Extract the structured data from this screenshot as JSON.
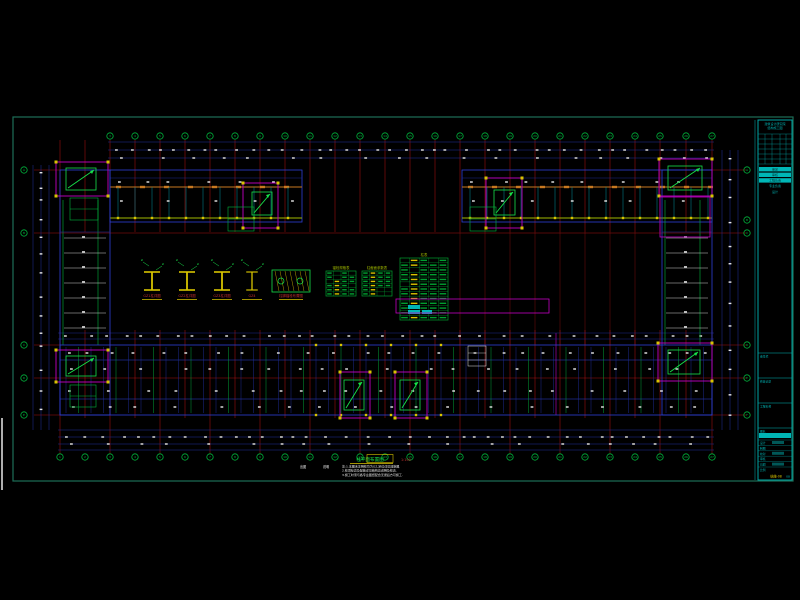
{
  "meta": {
    "canvas_w": 800,
    "canvas_h": 600
  },
  "colors": {
    "background": "#000000",
    "frame": "#1d6e58",
    "grid_red": "#a81212",
    "beam_blue": "#2d3fd6",
    "beam_blue_dim": "#1f2f9e",
    "joist_cyan": "#00939e",
    "green": "#00b43c",
    "bright_green": "#17e24a",
    "magenta": "#c400c4",
    "yellow": "#d8c400",
    "orange": "#c87820",
    "olive": "#9fb800",
    "cyan": "#00b6b6",
    "white": "#e8e8e8",
    "label_red": "#c23030",
    "table_green": "#00a030"
  },
  "footer": {
    "legend_a": "出图",
    "legend_b": "说明",
    "title": "柱平面布置图",
    "scale": "1:100",
    "notes": [
      "注:1.本图未注明柱均为GZ,定位详见建施图.",
      "2.柱顶标高及配筋详见结构总说明及柱表.",
      "3.施工时须与各专业图纸配合无误后方可施工."
    ]
  },
  "details": {
    "items": [
      {
        "label": "GZ1柱详图"
      },
      {
        "label": "GZ2柱详图"
      },
      {
        "label": "GZ3柱详图"
      },
      {
        "label": "GZ4"
      },
      {
        "label": "柱脚锚栓布置图"
      }
    ],
    "small_tables": [
      {
        "title": "锚栓规格表",
        "rows": 6,
        "cols": 4
      },
      {
        "title": "柱截面参数表",
        "rows": 6,
        "cols": 4
      }
    ],
    "main_table": {
      "title": "柱表",
      "rows": 13,
      "cols": 5
    }
  },
  "title_block": {
    "header": [
      "建筑设计研究院",
      "结构施工图"
    ],
    "rev_rows": 6,
    "info_rows": [
      "审定",
      "审核",
      "工程负责",
      "专业负责",
      "设计"
    ],
    "sections": [
      "会签栏",
      "修改记录",
      "工程名称",
      "图名"
    ],
    "stamp": {
      "labels": [
        "设计",
        "制图",
        "校对",
        "审核",
        "日期",
        "比例"
      ],
      "drawing_no": "结施-08",
      "sheet": "08"
    }
  },
  "drawing": {
    "frame": {
      "x": 13,
      "y": 117,
      "w": 780,
      "h": 364
    },
    "edge_line": {
      "x": 2,
      "y1": 418,
      "y2": 490
    },
    "axes_x": [
      60,
      85,
      110,
      135,
      160,
      185,
      210,
      235,
      260,
      285,
      310,
      335,
      360,
      385,
      410,
      435,
      460,
      485,
      510,
      535,
      560,
      585,
      610,
      635,
      660,
      686,
      712
    ],
    "courtyard_x": [
      460,
      485,
      510,
      535,
      560,
      585,
      610,
      635
    ],
    "haxes": [
      {
        "y": 233,
        "x1": 34,
        "x2": 746
      },
      {
        "y": 378,
        "x1": 34,
        "x2": 746
      }
    ],
    "left_bubble_ys": [
      170,
      233,
      345,
      378,
      415
    ],
    "right_bubble_ys": [
      170,
      220,
      233,
      345,
      378,
      415
    ],
    "top_bubble_y": 136,
    "bottom_bubble_y": 457,
    "wings": {
      "top_left": {
        "x": 110,
        "y": 170,
        "w": 192,
        "h": 52
      },
      "top_right": {
        "x": 462,
        "y": 170,
        "w": 250,
        "h": 52
      },
      "left": {
        "x": 60,
        "y": 170,
        "w": 50,
        "h": 245
      },
      "right": {
        "x": 662,
        "y": 170,
        "w": 50,
        "h": 245
      },
      "bottom": {
        "x": 60,
        "y": 345,
        "w": 652,
        "h": 70
      }
    },
    "cores": [
      {
        "r": [
          56,
          162,
          52,
          34
        ],
        "inner": [
          66,
          168,
          30,
          22
        ],
        "sub": [
          70,
          198,
          28,
          22
        ]
      },
      {
        "r": [
          243,
          183,
          35,
          45
        ],
        "inner": [
          252,
          192,
          20,
          23
        ],
        "sub": [
          228,
          207,
          26,
          24
        ]
      },
      {
        "r": [
          486,
          178,
          36,
          50
        ],
        "inner": [
          494,
          190,
          21,
          25
        ],
        "sub": [
          470,
          207,
          26,
          24
        ]
      },
      {
        "r": [
          659,
          159,
          53,
          37
        ],
        "inner": [
          668,
          166,
          34,
          24
        ],
        "sub": null
      },
      {
        "r": [
          56,
          350,
          52,
          32
        ],
        "inner": [
          66,
          356,
          30,
          20
        ],
        "sub": [
          70,
          385,
          26,
          22
        ]
      },
      {
        "r": [
          340,
          372,
          30,
          46
        ],
        "inner": [
          344,
          380,
          20,
          30
        ],
        "sub": null
      },
      {
        "r": [
          395,
          372,
          32,
          46
        ],
        "inner": [
          400,
          380,
          20,
          30
        ],
        "sub": null
      },
      {
        "r": [
          658,
          343,
          54,
          38
        ],
        "inner": [
          668,
          350,
          32,
          24
        ],
        "sub": null
      }
    ],
    "extra_magenta": [
      [
        660,
        197,
        50,
        40
      ]
    ],
    "magenta_vline": {
      "x": 556,
      "y1": 333,
      "y2": 415
    },
    "select_box": [
      396,
      299,
      153,
      14
    ],
    "dims": {
      "top_ys": [
        142,
        150,
        158
      ],
      "bottom_ys": [
        430,
        437,
        444,
        450
      ],
      "mid_ys": [
        333,
        339
      ],
      "left_xs": [
        33,
        41,
        49
      ],
      "right_xs": [
        722,
        730,
        738
      ]
    },
    "title_block_box": {
      "x": 758,
      "y": 120,
      "w": 34,
      "h": 360
    }
  }
}
